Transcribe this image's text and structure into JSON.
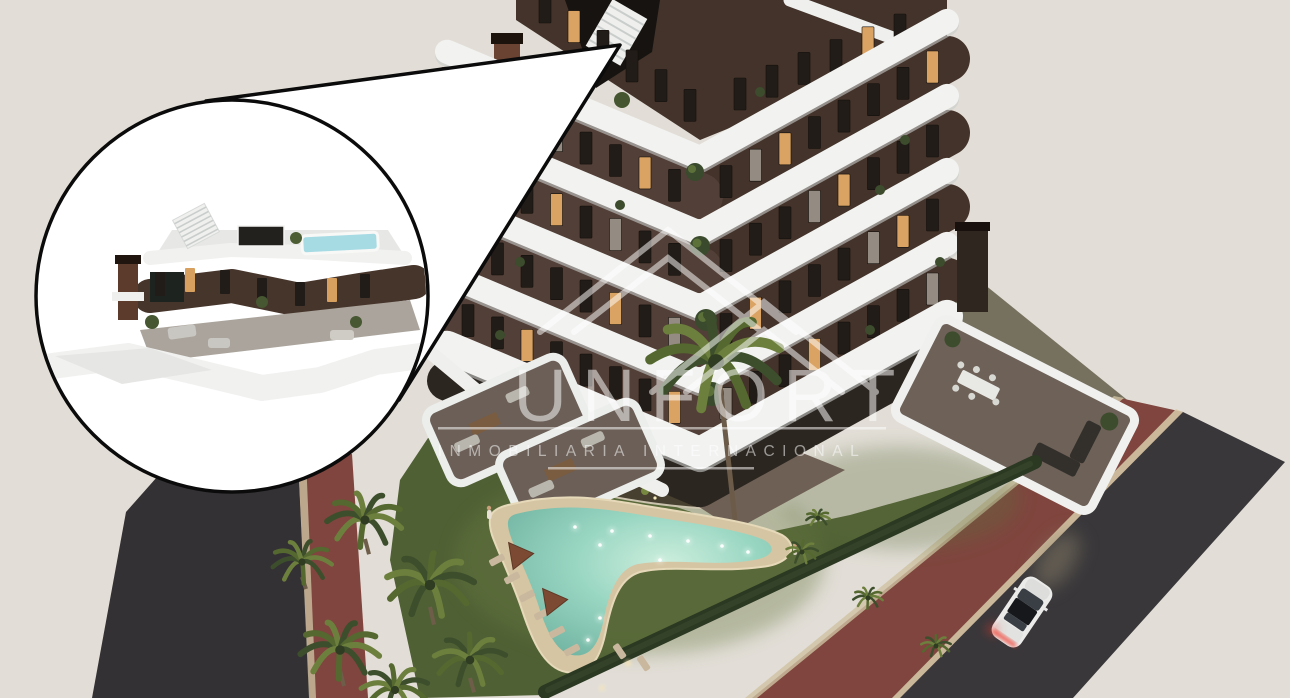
{
  "watermark": {
    "brand_visible": "UNFORT",
    "subtitle": "INMOBILIARIA INTERNACIONAL",
    "logo": "roofline-chevrons-icon",
    "text_color": "#ffffff"
  },
  "callout": {
    "type": "zoom-inset",
    "shape": "circle-with-pointer-wedge",
    "border_color": "#0b0b0b",
    "fill_color": "#ffffff",
    "content_label": "penthouse-roof-terrace-detail",
    "features": [
      "rooftop plunge pool",
      "roof deck",
      "staircase",
      "chimney",
      "wraparound white balcony",
      "terrace furniture"
    ]
  },
  "scene": {
    "description": "dusk aerial 3D render of a modern apartment tower with curved white balcony bands and dark brown facade, courtyard garden, glowing boomerang pool, palm trees, hedge, perimeter footpath and asphalt road",
    "building_floors_visible": 7,
    "car": {
      "color": "white",
      "lights_on": true,
      "taillight_color": "#e8402f"
    },
    "pool": {
      "shape": "boomerang",
      "underwater_lights": true
    }
  },
  "palette": {
    "background": "#e2ded7",
    "facade_brown": "#43332a",
    "facade_brown_light": "#55423a",
    "slab_white": "#f2f3f1",
    "window_dark": "#221c18",
    "window_lit": "#daa263",
    "lawn": "#55663a",
    "pool_water": "#8ed0bd",
    "pool_deck": "#d5c5a3",
    "hedge": "#2b3822",
    "asphalt": "#39373a",
    "red_path": "#7f453e",
    "curb": "#d8cbaa"
  }
}
